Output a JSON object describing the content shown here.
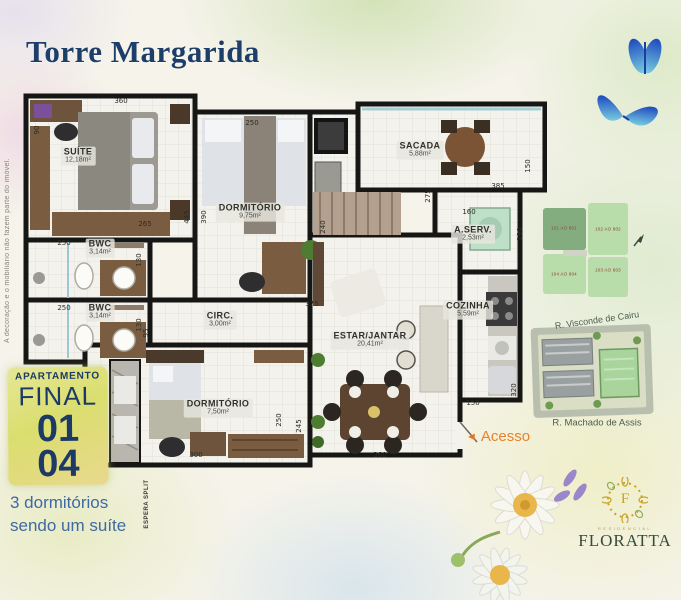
{
  "title": "Torre Margarida",
  "disclaimer": "A decoração e o mobiliário não fazem parte do imóvel.",
  "apartment_badge": {
    "line1": "APARTAMENTO",
    "line2": "FINAL",
    "number1": "01",
    "number2": "04"
  },
  "tagline_line1": "3 dormitórios",
  "tagline_line2": "sendo um suíte",
  "access": {
    "arrow": "◄",
    "label": "Acesso"
  },
  "floorplan": {
    "espera_split_label": "ESPERA SPLIT",
    "rooms": [
      {
        "name": "SUÍTE",
        "area": "12,18m²"
      },
      {
        "name": "DORMITÓRIO",
        "area": "9,75m²"
      },
      {
        "name": "SACADA",
        "area": "5,88m²"
      },
      {
        "name": "A.SERV.",
        "area": "2,53m²"
      },
      {
        "name": "COZINHA",
        "area": "5,59m²"
      },
      {
        "name": "ESTAR/JANTAR",
        "area": "20,41m²"
      },
      {
        "name": "CIRC.",
        "area": "3,00m²"
      },
      {
        "name": "BWC",
        "area": "3,14m²"
      },
      {
        "name": "BWC",
        "area": "3,14m²"
      },
      {
        "name": "DORMITÓRIO",
        "area": "7,50m²"
      }
    ],
    "dimensions": [
      "360",
      "90",
      "250",
      "445",
      "390",
      "265",
      "250",
      "130",
      "250",
      "130",
      "95",
      "240",
      "275",
      "375",
      "300",
      "250",
      "245",
      "360",
      "150",
      "320",
      "160",
      "190",
      "385",
      "150"
    ]
  },
  "unit_locator": {
    "highlighted_unit": "101 AO 801",
    "units": [
      {
        "label": "101 AO 801"
      },
      {
        "label": "102 AO 802"
      },
      {
        "label": "104 AO 804"
      },
      {
        "label": "103 AO 803"
      }
    ]
  },
  "site_map": {
    "street_top": "R. Visconde de Cairu",
    "street_bottom": "R. Machado de Assis"
  },
  "logo": {
    "monogram": "F",
    "subtitle": "RESIDENCIAL",
    "brand": "FLORATTA"
  },
  "colors": {
    "title": "#1e3e6a",
    "accent_orange": "#e8741e",
    "badge_text": "#1d3a66",
    "tagline": "#3f69a2",
    "wall": "#161614",
    "highlight_green": "#84ad7f"
  }
}
